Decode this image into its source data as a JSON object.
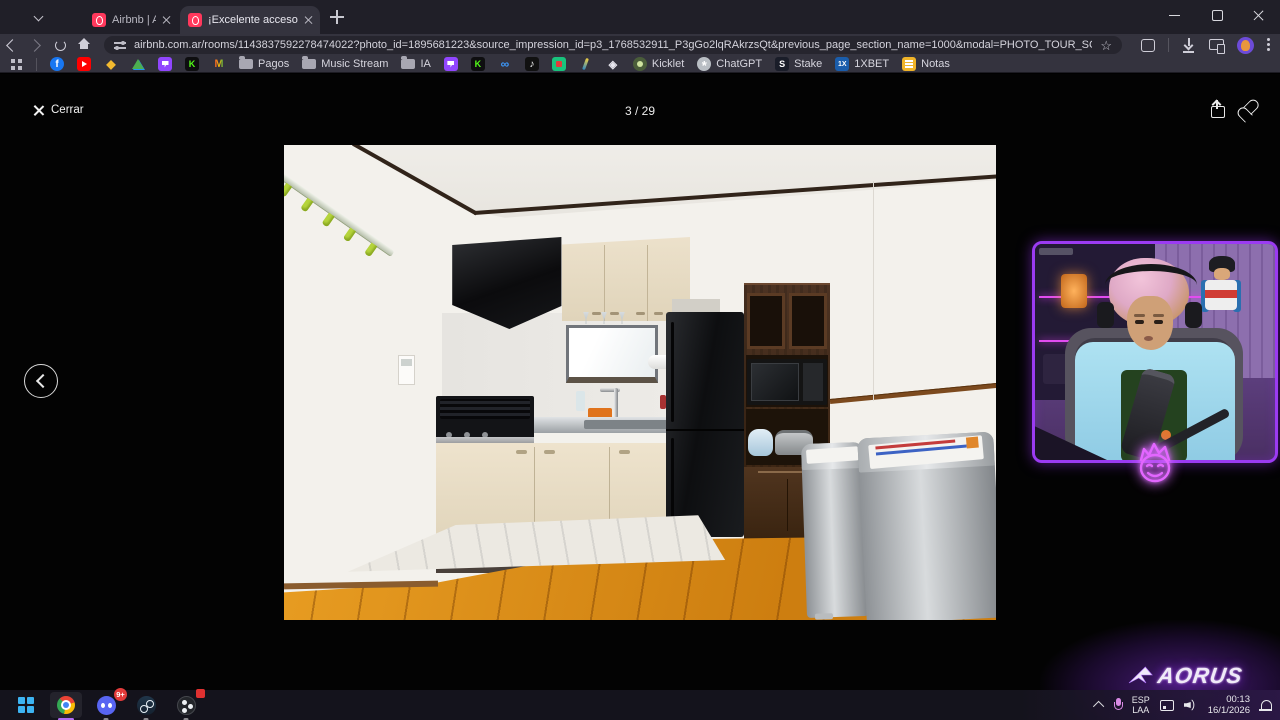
{
  "browser": {
    "tabs": [
      {
        "label": "Airbnb | Alojamientos para vaca",
        "active": false
      },
      {
        "label": "¡Excelente acceso al centro de l",
        "active": true
      }
    ],
    "url": "airbnb.com.ar/rooms/1143837592278474022?photo_id=1895681223&source_impression_id=p3_1768532911_P3gGo2lqRAkrzsQt&previous_page_section_name=1000&modal=PHOTO_TOUR_SCROLLABLE&modalItem=1895679573"
  },
  "bookmarks": {
    "folder_pagos": "Pagos",
    "folder_music": "Music Stream",
    "folder_ia": "IA",
    "kicklet": "Kicklet",
    "chatgpt": "ChatGPT",
    "stake": "Stake",
    "onexbet": "1XBET",
    "notas": "Notas"
  },
  "viewer": {
    "close_label": "Cerrar",
    "counter": "3 / 29"
  },
  "overlay": {
    "brand": "AORUS"
  },
  "taskbar": {
    "discord_badge": "9+"
  },
  "tray": {
    "lang1": "ESP",
    "lang2": "LAA",
    "time": "00:13",
    "date": "16/1/2026"
  },
  "colors": {
    "accent_purple": "#9b3bf2",
    "chrome_toolbar": "#34333e",
    "tabstrip": "#201f28",
    "page_bg": "#030303",
    "taskbar_bg": "#15141e",
    "airbnb_pink": "#ff385c"
  }
}
